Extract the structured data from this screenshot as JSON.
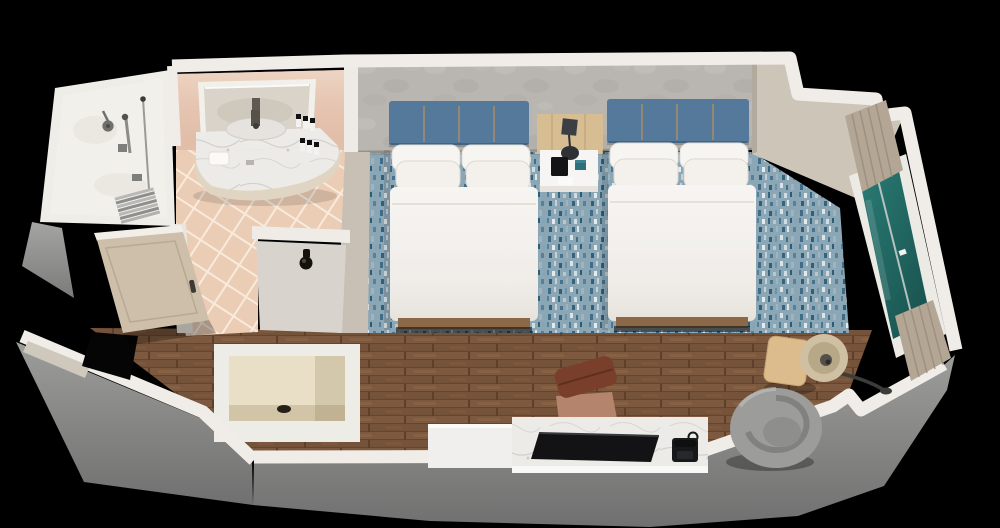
{
  "scene": {
    "view": "3d-cutaway-floorplan-render",
    "room_type": "hotel-guest-room-two-queen-beds",
    "background_color": "#000000",
    "areas": [
      "walk-in-shower",
      "vanity-bathroom",
      "entry-vestibule",
      "closet",
      "sleeping-area",
      "work-lounge-area"
    ],
    "furniture": [
      "queen-bed-1",
      "queen-bed-2",
      "nightstand-with-lamp",
      "area-rug",
      "bathroom-door",
      "wall-hook",
      "desk-with-tv",
      "telephone",
      "desk-chair",
      "round-swivel-chair",
      "floor-lamp",
      "side-table",
      "window-with-curtains",
      "vanity-mirror",
      "curved-marble-counter",
      "amenity-bottles",
      "towel",
      "shower-head",
      "hand-shower",
      "corrugated-shower-mat"
    ]
  },
  "palette": {
    "background": "#000000",
    "wall_top": "#f0ede8",
    "wall_exterior": "#8f8f8d",
    "accent_wall": "#b9b6b1",
    "right_wall": "#cdc5b8",
    "side_wall": "#c8c0b5",
    "vanity_wall": "#e5c2ad",
    "tile_floor": "#ebccb5",
    "wood_floor": "#7d5a3f",
    "carpet_base": "#8ba7b5",
    "headboard": "#54799b",
    "headboard_seam": "#b5905f",
    "bedding": "#f6f4f1",
    "duvet": "#f3f1ee",
    "nightstand_wood": "#d6bd92",
    "nightstand_top": "#f6f5f3",
    "lamp_dark": "#3b3f44",
    "window_glass": "#1f5f5c",
    "curtain": "#b3a694",
    "side_table": "#dcbc8c",
    "lamp_shade": "#cfc0a3",
    "lounge_chair": "#9c9c9a",
    "desk_marble": "#edebe7",
    "tv": "#131316",
    "desk_chair_back": "#7a3f2a",
    "desk_chair_seat": "#b5846c",
    "door": "#cdbfa9",
    "closet_interior": "#e9dfc6",
    "marble_counter": "#edebe7",
    "shower_interior": "#f2f0ea",
    "hook_wall": "#d8d4cd"
  }
}
